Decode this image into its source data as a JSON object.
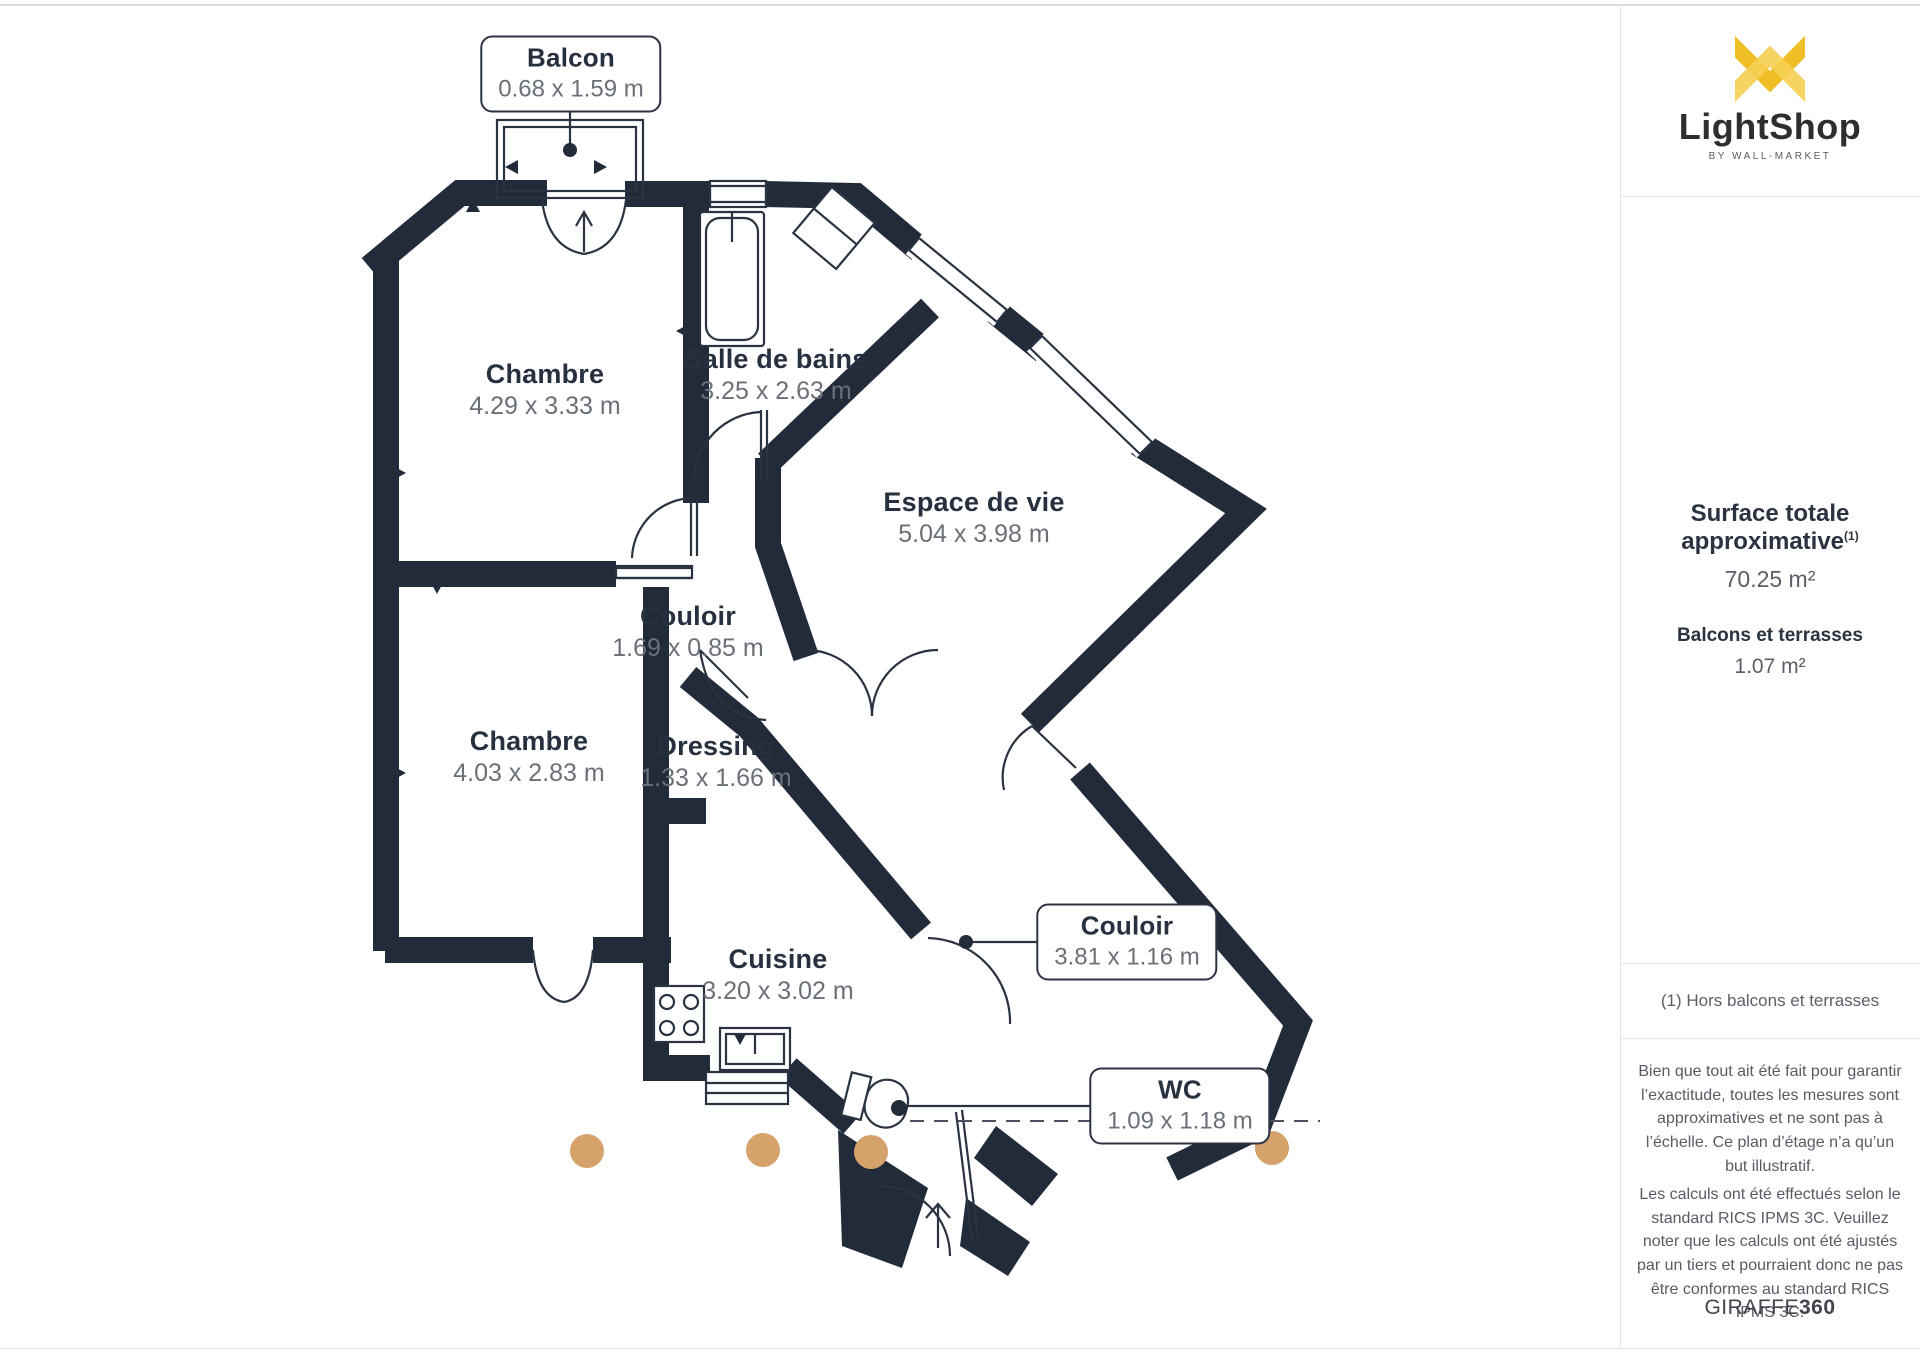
{
  "branding": {
    "name": "LightShop",
    "tagline": "BY WALL-MARKET"
  },
  "sidebar": {
    "surface_title": "Surface totale approximative",
    "surface_sup": "(1)",
    "surface_value": "70.25 m²",
    "balconies_title": "Balcons et terrasses",
    "balconies_value": "1.07 m²",
    "footnote": "(1) Hors balcons et terrasses",
    "disclaimer1": "Bien que tout ait été fait pour garantir l’exactitude, toutes les mesures sont approximatives et ne sont pas à l’échelle. Ce plan d’étage n’a qu’un but illustratif.",
    "disclaimer2": "Les calculs ont été effectués selon le standard RICS IPMS 3C. Veuillez noter que les calculs ont été ajustés par un tiers et pourraient donc ne pas être conformes au standard RICS IPMS 3C.",
    "brand_footer_regular": "GIRAFFE",
    "brand_footer_bold": "360"
  },
  "rooms": {
    "balcon": {
      "name": "Balcon",
      "dims": "0.68 x 1.59 m"
    },
    "chambre1": {
      "name": "Chambre",
      "dims": "4.29 x 3.33 m"
    },
    "salle_de_bains": {
      "name": "Salle de bains",
      "dims": "3.25 x 2.63 m"
    },
    "espace_de_vie": {
      "name": "Espace de vie",
      "dims": "5.04 x 3.98 m"
    },
    "couloir1": {
      "name": "Couloir",
      "dims": "1.69 x 0.85 m"
    },
    "chambre2": {
      "name": "Chambre",
      "dims": "4.03 x 2.83 m"
    },
    "dressing": {
      "name": "Dressing",
      "dims": "1.33 x 1.66 m"
    },
    "cuisine": {
      "name": "Cuisine",
      "dims": "3.20 x 3.02 m"
    },
    "couloir2": {
      "name": "Couloir",
      "dims": "3.81 x 1.16 m"
    },
    "wc": {
      "name": "WC",
      "dims": "1.09 x 1.18 m"
    }
  },
  "colors": {
    "wall": "#222B3A",
    "brand_gold": "#EFBD24",
    "brand_gold_light": "#F6D055",
    "camera_dot": "#D5A26C"
  }
}
